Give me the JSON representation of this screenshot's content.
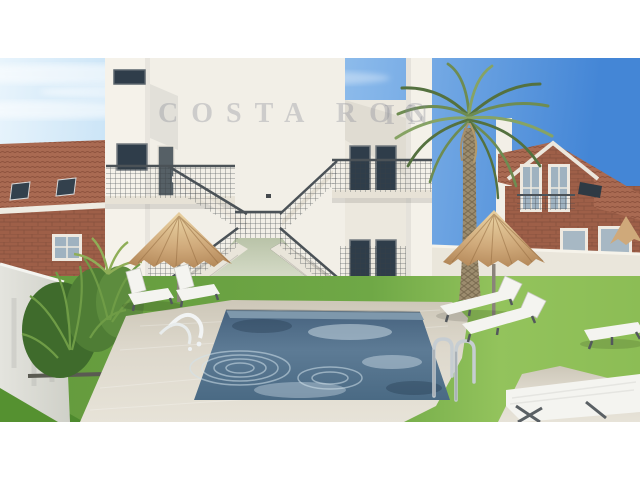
{
  "watermark": {
    "left": "COSTA ROC",
    "right": "IN"
  },
  "palette": {
    "sky_deep": "#4486d6",
    "sky_pale": "#e8f4fc",
    "wall_white": "#f2efe7",
    "wall_shadow": "#ddd6c8",
    "railing": "#4b5257",
    "window": "#2f3d4a",
    "roof": "#a96a52",
    "brick": "#9e5f48",
    "grass": "#6aa342",
    "grass_light": "#93c35c",
    "paving": "#d9d4c8",
    "water": "#54738f",
    "water_dark": "#3d5a77",
    "thatch": "#cfa97a",
    "palm": "#6e8c52",
    "trunk": "#9c8c6e",
    "chrome": "#c6cdd2",
    "letterbox": "#ffffff"
  }
}
